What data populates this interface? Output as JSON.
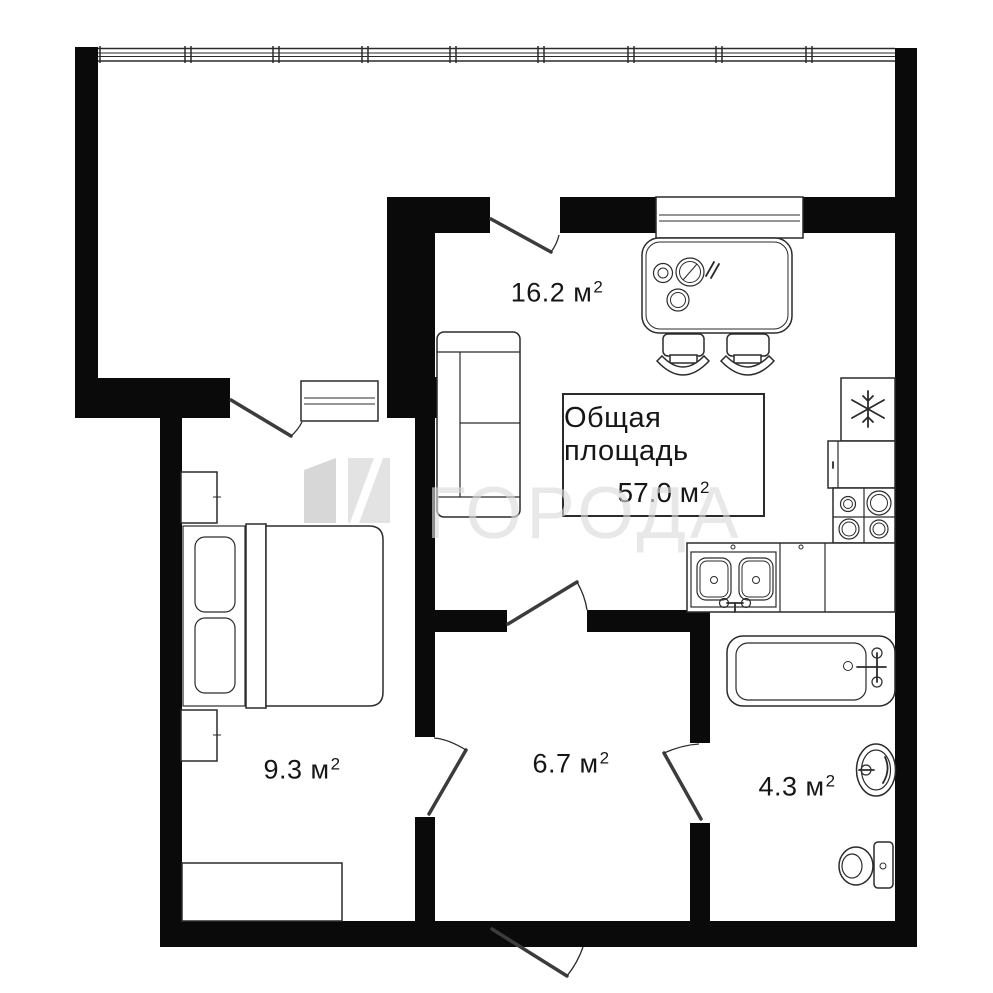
{
  "total_area_box": {
    "line1": "Общая площадь",
    "value": "57.0 м",
    "sup": "2"
  },
  "room_labels": {
    "living_kitchen": {
      "value": "16.2 м",
      "sup": "2"
    },
    "bedroom": {
      "value": "9.3 м",
      "sup": "2"
    },
    "hallway": {
      "value": "6.7 м",
      "sup": "2"
    },
    "bathroom": {
      "value": "4.3 м",
      "sup": "2"
    }
  },
  "watermark": {
    "text": "ГОРОДА",
    "logo": "goroda-square-logo"
  },
  "icons": {
    "fridge": "snowflake-icon"
  },
  "colors": {
    "wall": "#0a0a0a",
    "line": "#2b2b2b",
    "background": "#ffffff",
    "watermark_text": "rgba(219,219,219,0.63)"
  }
}
